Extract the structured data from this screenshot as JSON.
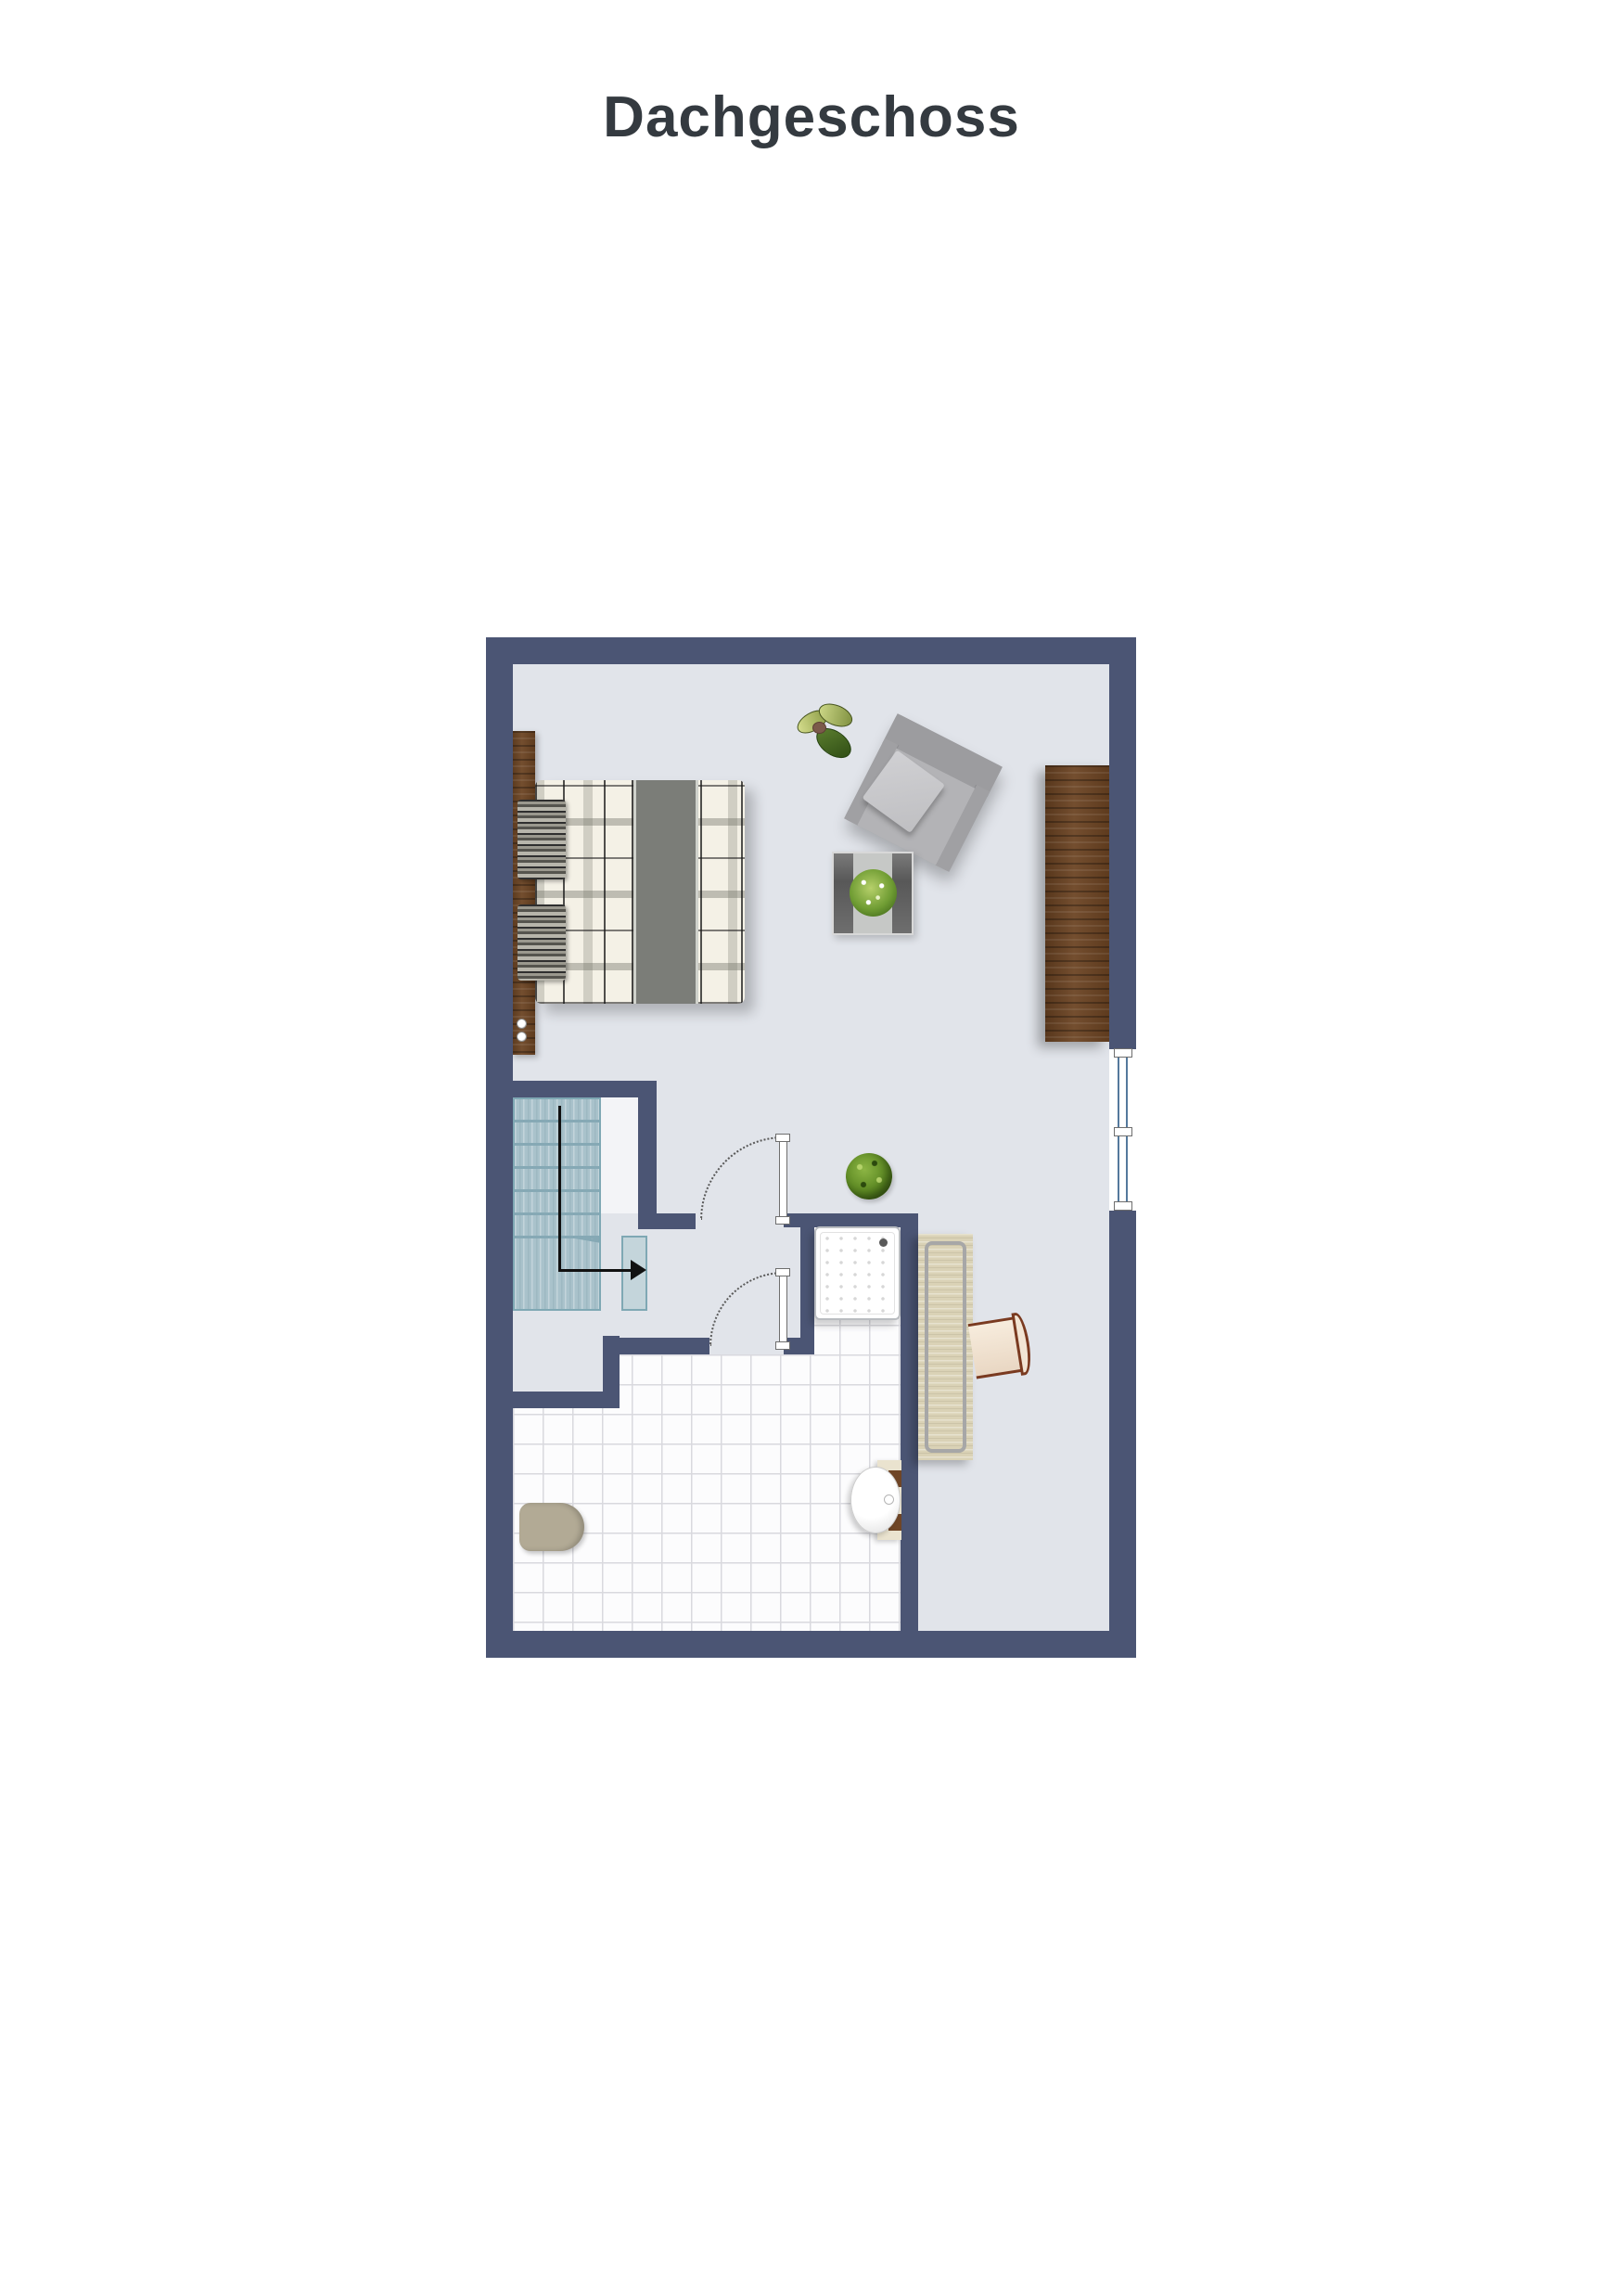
{
  "page": {
    "title": "Dachgeschoss"
  },
  "colors": {
    "wall": "#4b5574",
    "floor": "#e1e4ea",
    "void": "#f3f4f7",
    "stair": "#a9c2cb",
    "stairLine": "#86a9b5",
    "stairBorder": "#7fa8b4",
    "stairLanding": "#c4d5db",
    "tile": "#fcfcfd",
    "tileLine": "#d9d9de",
    "wood": "#6b4322",
    "bench": "#dad2b6",
    "windowGlass": "#54799c",
    "arrow": "#111111",
    "titleColor": "#343a40"
  }
}
